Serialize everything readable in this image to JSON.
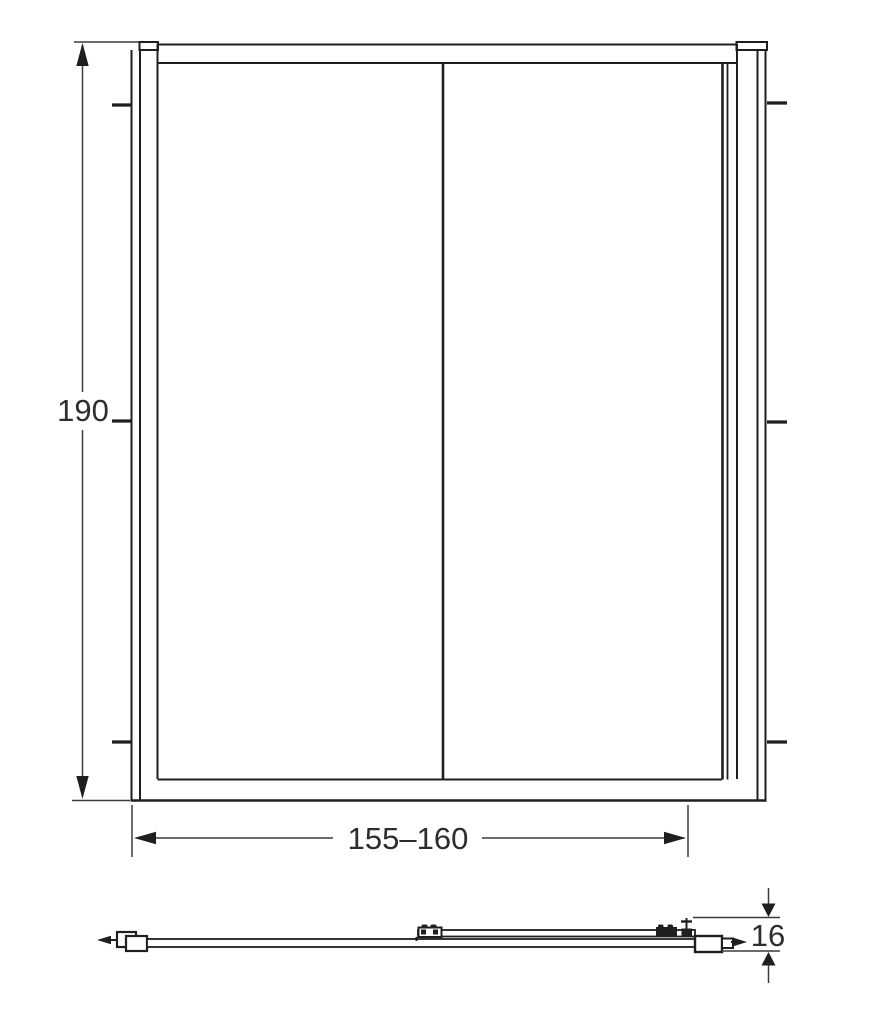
{
  "dimensions": {
    "height": {
      "value": "190"
    },
    "width": {
      "value": "155–160"
    },
    "thickness": {
      "value": "16"
    }
  },
  "colors": {
    "line": "#1f1f1f",
    "dimension_line": "#3c3c3c",
    "text": "#2d2d2d",
    "background": "#ffffff"
  }
}
